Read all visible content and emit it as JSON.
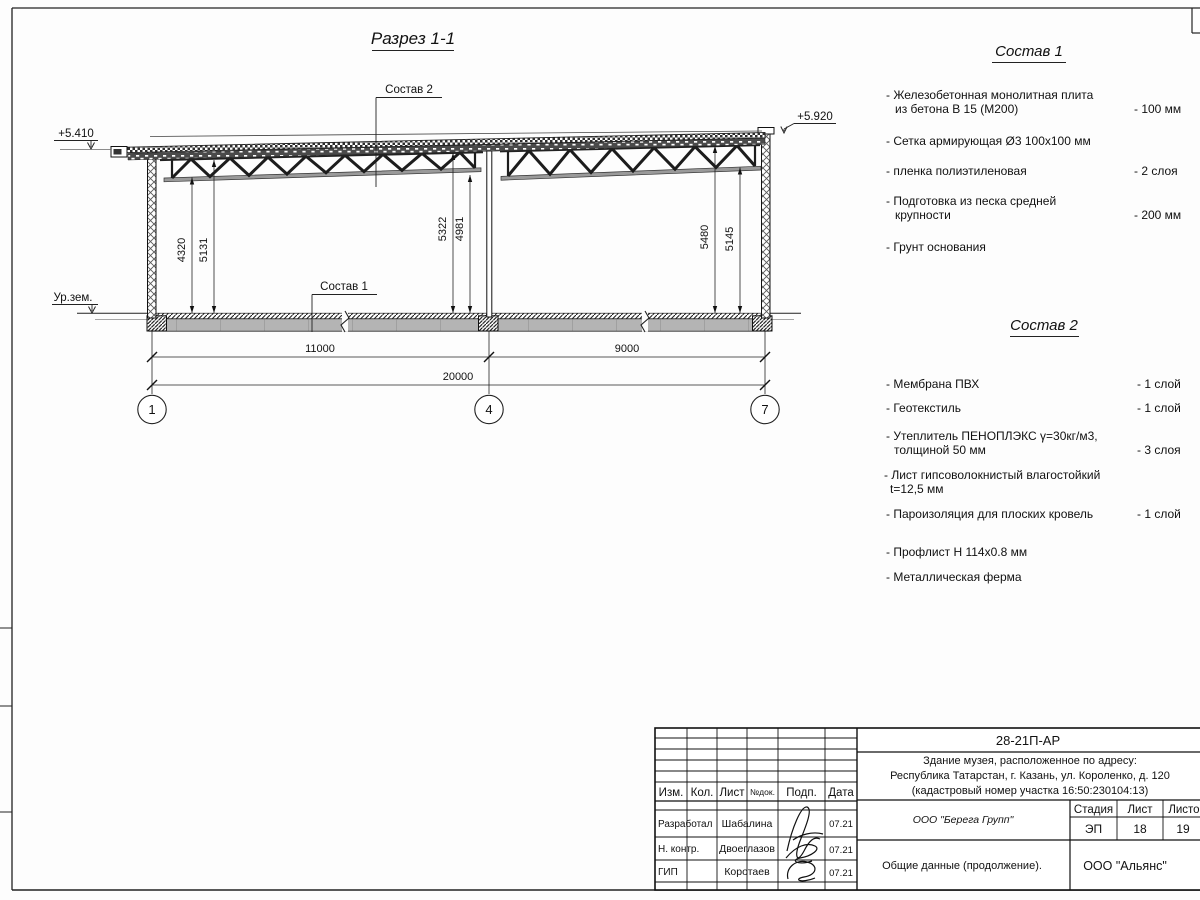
{
  "sheet": {
    "section_title": "Разрез 1-1",
    "elevations": {
      "roof_left": "+5.410",
      "roof_right": "+5.920",
      "ground": "Ур.зем."
    },
    "callouts": {
      "sostav1": "Состав 1",
      "sostav2": "Состав 2"
    },
    "dimensions": {
      "vertical": [
        "4320",
        "5131",
        "5322",
        "4981",
        "5480",
        "5145"
      ],
      "horizontal": [
        "11000",
        "9000",
        "20000"
      ]
    },
    "axes": [
      "1",
      "4",
      "7"
    ]
  },
  "sostav1": {
    "heading": "Состав 1",
    "items": [
      {
        "l1": "- Железобетонная  монолитная плита",
        "l2": "из бетона В 15 (М200)",
        "v": "- 100 мм"
      },
      {
        "l1": "- Сетка армирующая Ø3 100x100 мм",
        "l2": "",
        "v": ""
      },
      {
        "l1": "- пленка полиэтиленовая",
        "l2": "",
        "v": "- 2  слоя"
      },
      {
        "l1": "- Подготовка из песка средней",
        "l2": "крупности",
        "v": "- 200 мм"
      },
      {
        "l1": "- Грунт основания",
        "l2": "",
        "v": ""
      }
    ]
  },
  "sostav2": {
    "heading": "Состав 2",
    "items": [
      {
        "l1": "- Мембрана ПВХ",
        "l2": "",
        "v": "- 1 слой"
      },
      {
        "l1": "- Геотекстиль",
        "l2": "",
        "v": "- 1 слой"
      },
      {
        "l1": "- Утеплитель ПЕНОПЛЭКС γ=30кг/м3,",
        "l2": "толщиной 50 мм",
        "v": "- 3 слоя"
      },
      {
        "l1": "- Лист гипсоволокнистый влагостойкий",
        "l2": "t=12,5 мм",
        "v": ""
      },
      {
        "l1": "- Пароизоляция для плоских кровель",
        "l2": "",
        "v": "- 1 слой"
      },
      {
        "l1": "- Профлист Н 114x0.8 мм",
        "l2": "",
        "v": ""
      },
      {
        "l1": "- Металлическая ферма",
        "l2": "",
        "v": ""
      }
    ]
  },
  "titleblock": {
    "doc_number": "28-21П-АР",
    "address_line1": "Здание музея, расположенное по адресу:",
    "address_line2": "Республика Татарстан, г. Казань, ул. Короленко, д. 120",
    "address_line3": "(кадастровый номер участка 16:50:230104:13)",
    "headers": {
      "izm": "Изм.",
      "kol": "Кол.",
      "list": "Лист",
      "ndok": "№док.",
      "podp": "Подп.",
      "data": "Дата"
    },
    "rows": [
      {
        "role": "Разработал",
        "name": "Шабалина",
        "date": "07.21"
      },
      {
        "role": "Н. контр.",
        "name": "Двоеглазов",
        "date": "07.21"
      },
      {
        "role": "ГИП",
        "name": "Коротаев",
        "date": "07.21"
      }
    ],
    "company": "ООО \"Берега Групп\"",
    "stage_label": "Стадия",
    "sheet_label": "Лист",
    "sheets_label": "Листов",
    "stage": "ЭП",
    "sheet": "18",
    "sheets": "19",
    "doc_title": "Общие данные (продолжение).",
    "org": "ООО \"Альянс\""
  }
}
